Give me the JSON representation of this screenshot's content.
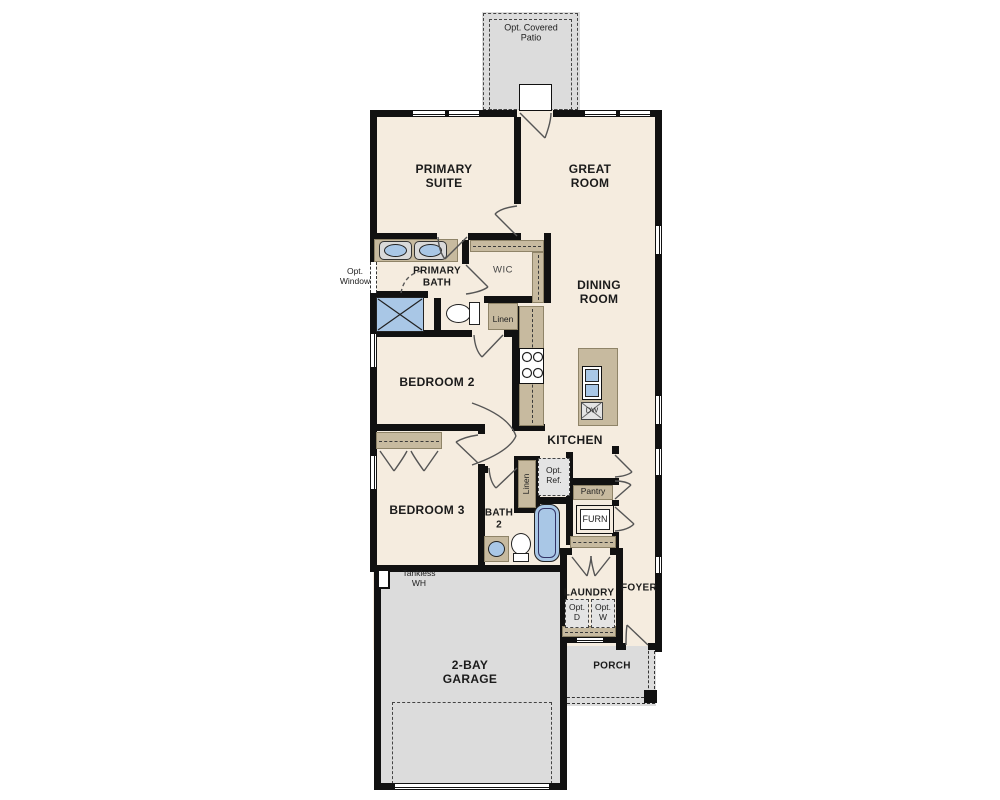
{
  "floor_plan": {
    "rooms": {
      "patio": "Opt. Covered Patio",
      "primary_suite": "PRIMARY SUITE",
      "great_room": "GREAT ROOM",
      "primary_bath": "PRIMARY BATH",
      "wic": "WIC",
      "dining_room": "DINING ROOM",
      "bedroom_2": "BEDROOM 2",
      "kitchen": "KITCHEN",
      "bedroom_3": "BEDROOM 3",
      "bath_2": "BATH 2",
      "laundry": "LAUNDRY",
      "foyer": "FOYER",
      "porch": "PORCH",
      "garage": "2-BAY GARAGE"
    },
    "annotations": {
      "opt_window": "Opt. Window",
      "linen_bath": "Linen",
      "linen_hall": "Linen",
      "opt_ref": "Opt. Ref.",
      "pantry": "Pantry",
      "furnace": "FURN",
      "dishwasher": "DW",
      "opt_dryer": "Opt. D",
      "opt_washer": "Opt. W",
      "tankless_wh": "Tankless WH"
    },
    "colors": {
      "wall": "#111111",
      "floor": "#f5ecdf",
      "concrete": "#dcdcdc",
      "casework": "#c7ba9f",
      "fixture_blue": "#a9c7e6"
    }
  }
}
